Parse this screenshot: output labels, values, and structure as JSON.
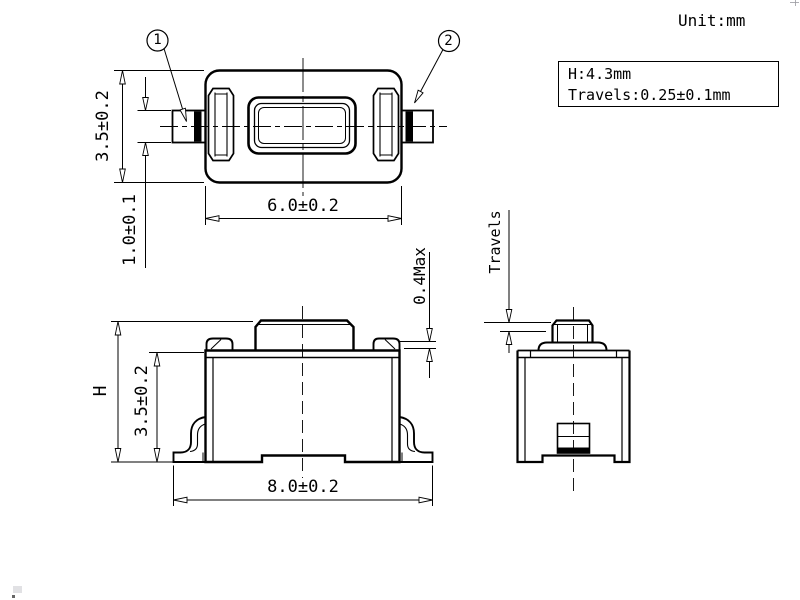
{
  "meta": {
    "unit_label": "Unit:mm"
  },
  "info_box": {
    "line1": "H:4.3mm",
    "line2": "Travels:0.25±0.1mm"
  },
  "top_view": {
    "callout_1": "1",
    "callout_2": "2",
    "dim_body_height": "3.5±0.2",
    "dim_lead_width": "1.0±0.1",
    "dim_body_width": "6.0±0.2"
  },
  "front_view": {
    "dim_total_height": "H",
    "dim_housing_height": "3.5±0.2",
    "dim_overall_width": "8.0±0.2",
    "dim_ear_clearance": "0.4Max"
  },
  "side_view": {
    "dim_travel_label": "Travels"
  },
  "colors": {
    "line": "#000000",
    "background": "#ffffff"
  }
}
